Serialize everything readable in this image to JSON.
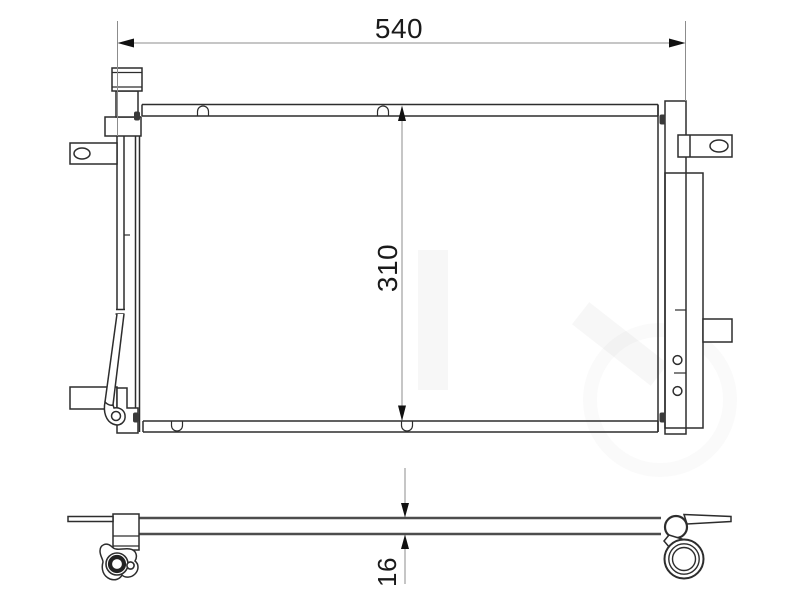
{
  "drawing": {
    "dimensions": {
      "width": {
        "value": "540"
      },
      "height": {
        "value": "310"
      },
      "depth": {
        "value": "16"
      }
    },
    "colors": {
      "background": "#ffffff",
      "outline": "#2d2d2d",
      "slab_line": "#4d4d4d",
      "dimension_line": "#8c8c8c",
      "dimension_text": "#1a1a1a",
      "arrowhead": "#111111"
    }
  }
}
